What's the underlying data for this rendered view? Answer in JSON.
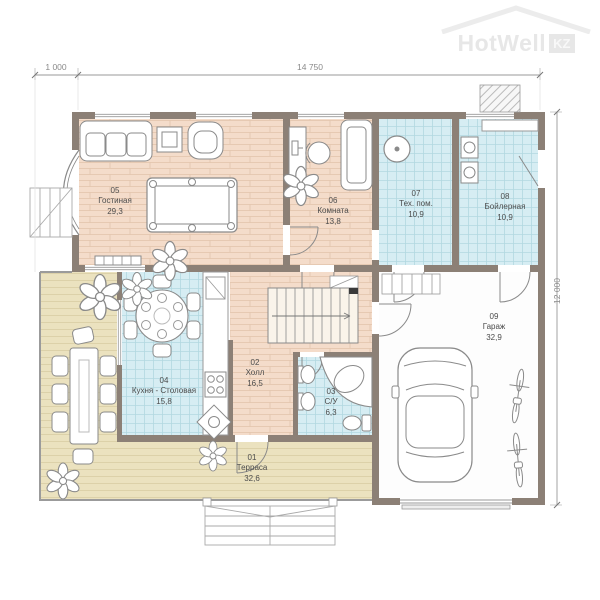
{
  "logo": {
    "text": "HotWell",
    "suffix": "KZ"
  },
  "dimensions": {
    "top_left": "1 000",
    "top_main": "14 750",
    "right": "12 000"
  },
  "rooms": [
    {
      "number": "01",
      "name": "Терраса",
      "area": "32,6"
    },
    {
      "number": "02",
      "name": "Холл",
      "area": "16,5"
    },
    {
      "number": "03",
      "name": "С/У",
      "area": "6,3"
    },
    {
      "number": "04",
      "name": "Кухня - Столовая",
      "area": "15,8"
    },
    {
      "number": "05",
      "name": "Гостиная",
      "area": "29,3"
    },
    {
      "number": "06",
      "name": "Комната",
      "area": "13,8"
    },
    {
      "number": "07",
      "name": "Тех. пом.",
      "area": "10,9"
    },
    {
      "number": "08",
      "name": "Бойлерная",
      "area": "10,9"
    },
    {
      "number": "09",
      "name": "Гараж",
      "area": "32,9"
    }
  ],
  "colors": {
    "wall": "#8c8076",
    "floor_wood": "#f4dcca",
    "floor_tile": "#d6edf3",
    "floor_deck": "#ebe2bf",
    "floor_garage": "#fdfdfd",
    "line": "#8a8a8a",
    "dimension_text": "#8a8a8a",
    "logo": "#e3e3e3"
  }
}
